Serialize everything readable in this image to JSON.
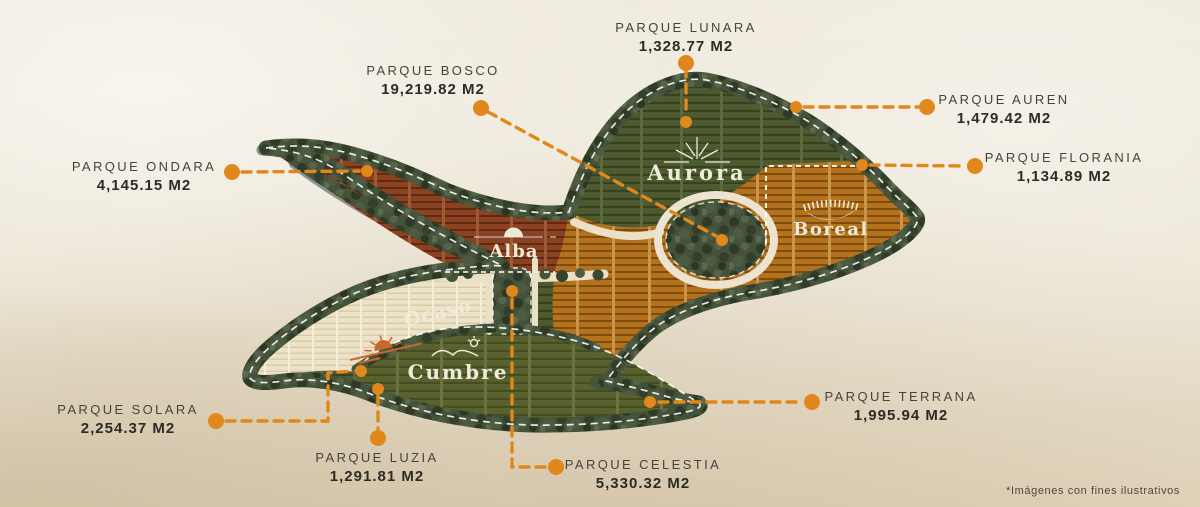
{
  "page": {
    "footnote": "*Imágenes con fines ilustrativos"
  },
  "accent_color": "#e0881b",
  "parks": {
    "lunara": {
      "name": "PARQUE LUNARA",
      "area": "1,328.77 M2"
    },
    "bosco": {
      "name": "PARQUE BOSCO",
      "area": "19,219.82 M2"
    },
    "auren": {
      "name": "PARQUE AUREN",
      "area": "1,479.42 M2"
    },
    "florania": {
      "name": "PARQUE FLORANIA",
      "area": "1,134.89 M2"
    },
    "ondara": {
      "name": "PARQUE ONDARA",
      "area": "4,145.15 M2"
    },
    "solara": {
      "name": "PARQUE SOLARA",
      "area": "2,254.37 M2"
    },
    "luzia": {
      "name": "PARQUE LUZIA",
      "area": "1,291.81 M2"
    },
    "celestia": {
      "name": "PARQUE CELESTIA",
      "area": "5,330.32 M2"
    },
    "terrana": {
      "name": "PARQUE TERRANA",
      "area": "1,995.94 M2"
    }
  },
  "zones": {
    "aurora": {
      "label": "Aurora",
      "color": "#4e5a2f"
    },
    "boreal": {
      "label": "Boreal",
      "color": "#b4721c"
    },
    "alba": {
      "label": "Alba",
      "color": "#8a4223"
    },
    "ocaso": {
      "label": "Ocaso",
      "color": "#ebe2c8",
      "text_color": "#c8682a"
    },
    "cumbre": {
      "label": "Cumbre",
      "color": "#59622f"
    }
  }
}
